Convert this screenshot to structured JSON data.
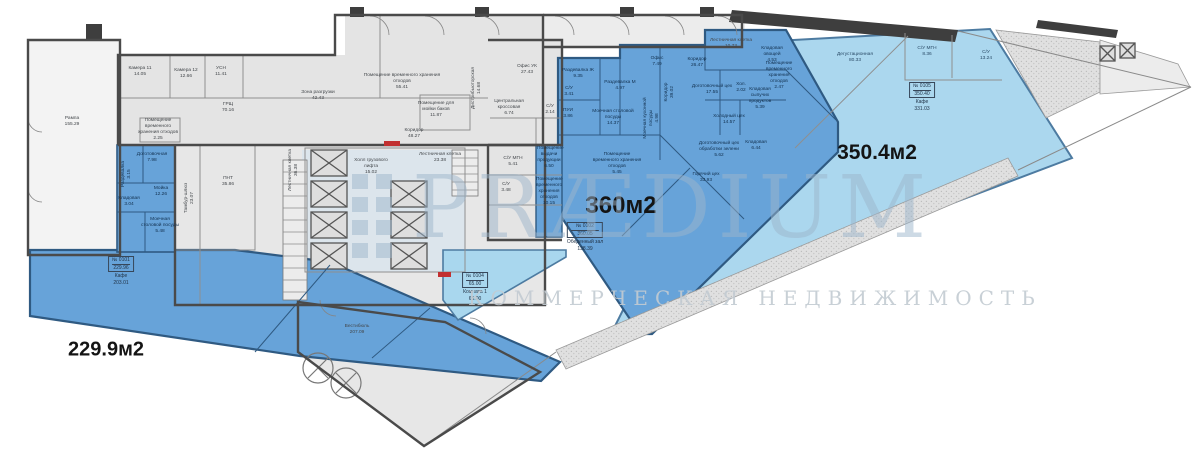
{
  "watermark": {
    "brand": "PRÆDIUM",
    "tagline": "КОММЕРЧЕСКАЯ НЕДВИЖИМОСТЬ"
  },
  "colors": {
    "zone_blue": "#67a3d9",
    "zone_light_blue": "#abd7ee",
    "floor_gray": "#e4e4e4",
    "wall_dark": "#4a4a4a",
    "brand_blue": "#9db6cc",
    "accent_red": "#c23030"
  },
  "area_stats": [
    {
      "text": "229.9м2",
      "x": 106,
      "y": 350,
      "size": 20
    },
    {
      "text": "360м2",
      "x": 621,
      "y": 206,
      "size": 24
    },
    {
      "text": "350.4м2",
      "x": 877,
      "y": 153,
      "size": 21
    }
  ],
  "units": [
    {
      "number": "№ 0101",
      "total": "229.96",
      "name": "Кафе",
      "area": "203.01",
      "x": 121,
      "y": 256
    },
    {
      "number": "№ 0102",
      "total": "360.05",
      "name": "Обеденный зал",
      "area": "138.39",
      "x": 585,
      "y": 222
    },
    {
      "number": "№ 0104",
      "total": "65.00",
      "name": "Комната 1",
      "area": "65.00",
      "x": 475,
      "y": 272
    },
    {
      "number": "№ 0105",
      "total": "350.40",
      "name": "Кафе",
      "area": "331.03",
      "x": 922,
      "y": 82
    }
  ],
  "rooms": [
    {
      "name": "Рампа",
      "area": "155.29",
      "x": 72,
      "y": 122,
      "tone": "g"
    },
    {
      "name": "Камера 11",
      "area": "14.05",
      "x": 140,
      "y": 72,
      "tone": "g"
    },
    {
      "name": "Камера 12",
      "area": "12.66",
      "x": 186,
      "y": 74,
      "tone": "g"
    },
    {
      "name": "УСН",
      "area": "11.41",
      "x": 221,
      "y": 72,
      "tone": "g"
    },
    {
      "name": "ГРЩ",
      "area": "70.16",
      "x": 228,
      "y": 108,
      "tone": "g"
    },
    {
      "name": "Помещение временного хранения отходов",
      "area": "2.25",
      "x": 158,
      "y": 130,
      "tone": "g",
      "w": 46
    },
    {
      "name": "ПНТ",
      "area": "35.86",
      "x": 228,
      "y": 182,
      "tone": "g"
    },
    {
      "name": "Тамбур-шлюз",
      "area": "23.07",
      "x": 190,
      "y": 198,
      "tone": "g",
      "rot": true
    },
    {
      "name": "Лестничная клетка",
      "area": "36.38",
      "x": 294,
      "y": 170,
      "tone": "g",
      "rot": true
    },
    {
      "name": "Зона разгрузки",
      "area": "42.43",
      "x": 318,
      "y": 96,
      "tone": "g"
    },
    {
      "name": "Помещение временного хранения отходов",
      "area": "55.41",
      "x": 402,
      "y": 82,
      "tone": "g",
      "w": 84
    },
    {
      "name": "Помещение для мойки баков",
      "area": "11.87",
      "x": 436,
      "y": 110,
      "tone": "g",
      "w": 46
    },
    {
      "name": "Коридор",
      "area": "48.27",
      "x": 414,
      "y": 134,
      "tone": "g"
    },
    {
      "name": "Холл грузового лифта",
      "area": "15.02",
      "x": 371,
      "y": 167,
      "tone": "g",
      "w": 42
    },
    {
      "name": "Лестничная клетка",
      "area": "23.38",
      "x": 440,
      "y": 158,
      "tone": "g",
      "w": 42
    },
    {
      "name": "Офис УК",
      "area": "27.43",
      "x": 527,
      "y": 70,
      "tone": "g"
    },
    {
      "name": "Центральная кроссовая",
      "area": "6.74",
      "x": 509,
      "y": 108,
      "tone": "g",
      "w": 40
    },
    {
      "name": "С/У",
      "area": "2.14",
      "x": 550,
      "y": 110,
      "tone": "g",
      "w": 20
    },
    {
      "name": "Дистрибьюторская",
      "area": "14.68",
      "x": 477,
      "y": 88,
      "tone": "g",
      "rot": true
    },
    {
      "name": "С/У МГН",
      "area": "5.41",
      "x": 513,
      "y": 162,
      "tone": "g"
    },
    {
      "name": "С/У",
      "area": "3.48",
      "x": 506,
      "y": 188,
      "tone": "g"
    },
    {
      "name": "Вестибюль",
      "area": "207.09",
      "x": 357,
      "y": 330,
      "tone": "g"
    },
    {
      "name": "Лестничная клетка",
      "area": "10.73",
      "x": 731,
      "y": 44,
      "tone": "g",
      "w": 42
    },
    {
      "name": "Доготовочная",
      "area": "7.98",
      "x": 152,
      "y": 158,
      "tone": "b"
    },
    {
      "name": "Раздевалка",
      "area": "3.15",
      "x": 127,
      "y": 174,
      "tone": "b",
      "rot": true
    },
    {
      "name": "Кладовая",
      "area": "3.04",
      "x": 129,
      "y": 202,
      "tone": "b",
      "w": 26
    },
    {
      "name": "Мойка",
      "area": "12.26",
      "x": 161,
      "y": 192,
      "tone": "b"
    },
    {
      "name": "Моечная столовой посуды",
      "area": "5.48",
      "x": 160,
      "y": 226,
      "tone": "b",
      "w": 40
    },
    {
      "name": "Раздевалка Ж",
      "area": "9.35",
      "x": 578,
      "y": 74,
      "tone": "b"
    },
    {
      "name": "С/У",
      "area": "3.41",
      "x": 569,
      "y": 92,
      "tone": "b",
      "w": 20
    },
    {
      "name": "ПУИ",
      "area": "3.86",
      "x": 568,
      "y": 114,
      "tone": "b",
      "w": 20
    },
    {
      "name": "Раздевалка М",
      "area": "4.97",
      "x": 620,
      "y": 86,
      "tone": "b"
    },
    {
      "name": "Офис",
      "area": "7.49",
      "x": 657,
      "y": 62,
      "tone": "b",
      "w": 30
    },
    {
      "name": "Коридор",
      "area": "39.02",
      "x": 670,
      "y": 92,
      "tone": "b",
      "rot": true
    },
    {
      "name": "Моечная столовой посуды",
      "area": "14.37",
      "x": 613,
      "y": 118,
      "tone": "b",
      "w": 42
    },
    {
      "name": "Моечная кухонной посуды",
      "area": "4.98",
      "x": 652,
      "y": 118,
      "tone": "b",
      "rot": true,
      "w": 44
    },
    {
      "name": "Коридор",
      "area": "26.47",
      "x": 697,
      "y": 63,
      "tone": "b"
    },
    {
      "name": "Доготовочный цех",
      "area": "17.55",
      "x": 712,
      "y": 90,
      "tone": "b",
      "w": 42
    },
    {
      "name": "Хол.",
      "area": "2.02",
      "x": 741,
      "y": 88,
      "tone": "b",
      "w": 20
    },
    {
      "name": "Кладовая сыпучих продуктов",
      "area": "5.39",
      "x": 760,
      "y": 99,
      "tone": "b",
      "w": 36
    },
    {
      "name": "Холодный цех",
      "area": "14.57",
      "x": 729,
      "y": 120,
      "tone": "b",
      "w": 44
    },
    {
      "name": "Доготовочный цех обработки зелени",
      "area": "5.62",
      "x": 719,
      "y": 150,
      "tone": "b",
      "w": 46
    },
    {
      "name": "Кладовая",
      "area": "6.44",
      "x": 756,
      "y": 146,
      "tone": "b",
      "w": 30
    },
    {
      "name": "Горячий цех",
      "area": "33.93",
      "x": 706,
      "y": 178,
      "tone": "b"
    },
    {
      "name": "Помещение временного хранения отходов",
      "area": "5.45",
      "x": 617,
      "y": 164,
      "tone": "b",
      "w": 50
    },
    {
      "name": "Кладовая овощей",
      "area": "4.53",
      "x": 772,
      "y": 55,
      "tone": "b",
      "w": 34
    },
    {
      "name": "Помещение временного хранения отходов",
      "area": "2.47",
      "x": 779,
      "y": 76,
      "tone": "b",
      "w": 36
    },
    {
      "name": "Помещение выдачи продукции",
      "area": "6.50",
      "x": 549,
      "y": 158,
      "tone": "b",
      "w": 24
    },
    {
      "name": "Помещение временного хранения отходов",
      "area": "10.15",
      "x": 549,
      "y": 192,
      "tone": "b",
      "w": 26
    },
    {
      "name": "Дегустационная",
      "area": "80.33",
      "x": 855,
      "y": 58,
      "tone": "lb"
    },
    {
      "name": "С/У МГН",
      "area": "8.36",
      "x": 927,
      "y": 52,
      "tone": "lb",
      "w": 26
    },
    {
      "name": "С/У",
      "area": "13.24",
      "x": 986,
      "y": 56,
      "tone": "lb",
      "w": 24
    }
  ]
}
